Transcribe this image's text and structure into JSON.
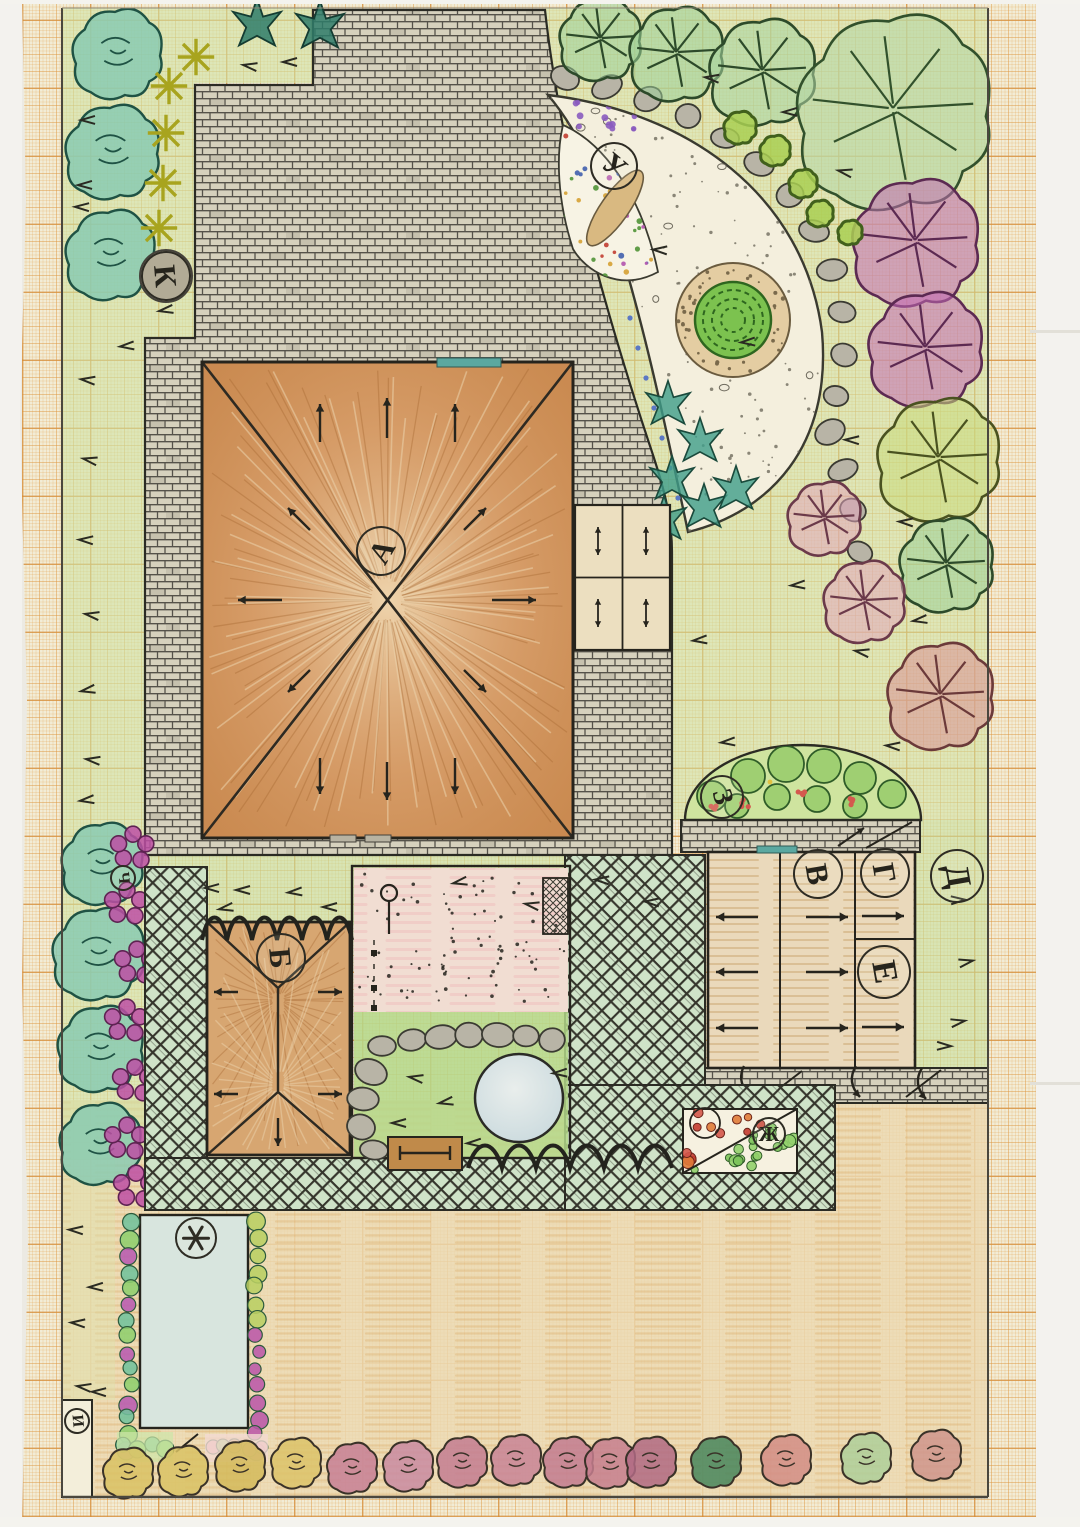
{
  "plan": {
    "description_labels_note": "hand-drawn garden plan, circled zone letters",
    "palette": {
      "paper": "#f2ecd6",
      "grid_orange": "#dd9a44",
      "lawn": "#c8e09b",
      "lawn_bright": "#b4d889",
      "brick": "#d6d1bd",
      "brick_joint": "#55524a",
      "roof_brown": "#d09a63",
      "roof_light": "#f2dcb6",
      "lattice_green": "#cfe3c8",
      "patio_pink": "#f1ddd2",
      "pond_blue": "#d9e4e2",
      "pool_water": "#d8e5de",
      "bare_ground_tan": "#ecd8b0",
      "teal_shrub": "#85c9b1",
      "magenta_flower": "#bd4fa5",
      "lime_bush": "#a9cf52",
      "window_teal": "#5ba8a0",
      "bench_wood": "#c08a4a",
      "box_orange": "#e0a33e"
    },
    "zone_labels": [
      {
        "letter": "А",
        "x": 381,
        "y": 551,
        "r": 25,
        "rot": -60
      },
      {
        "letter": "Б",
        "x": 281,
        "y": 958,
        "r": 25,
        "rot": 85
      },
      {
        "letter": "В",
        "x": 818,
        "y": 874,
        "r": 25,
        "rot": 80
      },
      {
        "letter": "Г",
        "x": 885,
        "y": 873,
        "r": 25,
        "rot": 80
      },
      {
        "letter": "Д",
        "x": 957,
        "y": 876,
        "r": 27,
        "rot": 80
      },
      {
        "letter": "Е",
        "x": 884,
        "y": 972,
        "r": 27,
        "rot": 80
      },
      {
        "letter": "Ж",
        "x": 769,
        "y": 1134,
        "r": 17,
        "rot": 0
      },
      {
        "letter": "З",
        "x": 722,
        "y": 797,
        "r": 22,
        "rot": 75
      },
      {
        "letter": "И",
        "x": 77,
        "y": 1421,
        "r": 13,
        "rot": 85
      },
      {
        "letter": "К",
        "x": 166,
        "y": 276,
        "r": 25,
        "rot": 85,
        "bg": "#b2ab96"
      },
      {
        "letter": "У",
        "x": 614,
        "y": 166,
        "r": 24,
        "rot": 40
      },
      {
        "letter": "Ч",
        "x": 123,
        "y": 878,
        "r": 13,
        "rot": 85
      },
      {
        "letter": "*",
        "x": 196,
        "y": 1238,
        "r": 21,
        "rot": 0,
        "star": true
      }
    ],
    "trees": [
      [
        600,
        38,
        40,
        "#9bcf97",
        "#2d4a2a"
      ],
      [
        676,
        52,
        46,
        "#9bcf97",
        "#2d4a2a"
      ],
      [
        762,
        70,
        52,
        "#a5d39e",
        "#2d4a2a"
      ],
      [
        893,
        108,
        95,
        "#b3d6a4",
        "#32512c"
      ],
      [
        915,
        240,
        62,
        "#c36ab4",
        "#5c2a52"
      ],
      [
        925,
        347,
        56,
        "#c36ab4",
        "#5c2a52"
      ],
      [
        938,
        457,
        60,
        "#c9da7c",
        "#4a5220"
      ],
      [
        946,
        563,
        46,
        "#9bcf97",
        "#2d4a2a"
      ],
      [
        864,
        600,
        40,
        "#e2a6bc",
        "#6b3a4a"
      ],
      [
        824,
        517,
        36,
        "#e2a6bc",
        "#6b3a4a"
      ],
      [
        940,
        694,
        52,
        "#d98f96",
        "#6b3a3a"
      ]
    ],
    "teal_shrubs": [
      [
        117,
        52,
        44
      ],
      [
        112,
        150,
        46
      ],
      [
        110,
        253,
        44
      ],
      [
        102,
        862,
        40
      ],
      [
        98,
        952,
        45
      ],
      [
        100,
        1047,
        42
      ],
      [
        100,
        1142,
        40
      ]
    ],
    "lime_bushes": [
      [
        740,
        127,
        16
      ],
      [
        775,
        150,
        15
      ],
      [
        803,
        183,
        14
      ],
      [
        820,
        213,
        13
      ],
      [
        850,
        232,
        12
      ]
    ],
    "magenta_clusters": [
      [
        133,
        847
      ],
      [
        127,
        903
      ],
      [
        137,
        962
      ],
      [
        127,
        1020
      ],
      [
        135,
        1080
      ],
      [
        127,
        1138
      ],
      [
        136,
        1186
      ]
    ],
    "yellow_flowers": [
      [
        196,
        57
      ],
      [
        169,
        86
      ],
      [
        166,
        133
      ],
      [
        163,
        183
      ],
      [
        159,
        228
      ]
    ],
    "dark_spiky_flowers": [
      [
        320,
        27
      ],
      [
        257,
        25
      ]
    ],
    "teal_plants": [
      [
        668,
        405
      ],
      [
        700,
        442
      ],
      [
        672,
        480
      ],
      [
        704,
        508
      ],
      [
        736,
        490
      ],
      [
        664,
        520
      ]
    ],
    "bed_bushes": [
      [
        712,
        796,
        15
      ],
      [
        748,
        776,
        17
      ],
      [
        786,
        764,
        18
      ],
      [
        824,
        766,
        17
      ],
      [
        860,
        778,
        16
      ],
      [
        892,
        794,
        14
      ],
      [
        737,
        806,
        12
      ],
      [
        777,
        797,
        13
      ],
      [
        817,
        799,
        13
      ],
      [
        855,
        806,
        12
      ]
    ],
    "bed_flower_dots": [
      [
        746,
        803
      ],
      [
        800,
        791
      ],
      [
        852,
        801
      ],
      [
        716,
        809
      ]
    ],
    "bottom_bushes": [
      [
        128,
        1472,
        "#d9c264"
      ],
      [
        183,
        1470,
        "#d9c264"
      ],
      [
        240,
        1465,
        "#d4ba5a"
      ],
      [
        296,
        1462,
        "#dcc36a"
      ],
      [
        352,
        1467,
        "#c77f95"
      ],
      [
        408,
        1465,
        "#c98ba2"
      ],
      [
        462,
        1461,
        "#c37d92"
      ],
      [
        516,
        1459,
        "#c88496"
      ],
      [
        568,
        1461,
        "#c27b90"
      ],
      [
        610,
        1462,
        "#c57e8e"
      ],
      [
        651,
        1461,
        "#b06a84"
      ],
      [
        716,
        1461,
        "#47855c"
      ],
      [
        786,
        1459,
        "#d28d86"
      ],
      [
        866,
        1457,
        "#aecf9a"
      ],
      [
        936,
        1454,
        "#cf958d"
      ]
    ],
    "stones_path": [
      [
        565,
        78
      ],
      [
        607,
        87
      ],
      [
        648,
        99
      ],
      [
        688,
        116
      ],
      [
        725,
        138
      ],
      [
        759,
        164
      ],
      [
        790,
        195
      ],
      [
        814,
        231
      ],
      [
        832,
        270
      ],
      [
        842,
        312
      ],
      [
        844,
        355
      ],
      [
        836,
        396
      ],
      [
        830,
        432
      ],
      [
        843,
        470
      ],
      [
        853,
        510
      ],
      [
        860,
        552
      ]
    ],
    "stones_lawn": [
      [
        382,
        1046
      ],
      [
        412,
        1040
      ],
      [
        441,
        1037
      ],
      [
        469,
        1035
      ],
      [
        498,
        1035
      ],
      [
        526,
        1036
      ],
      [
        552,
        1040
      ],
      [
        371,
        1072
      ],
      [
        363,
        1099
      ],
      [
        361,
        1127
      ],
      [
        374,
        1150
      ]
    ],
    "blue_dot_chain": [
      [
        630,
        318
      ],
      [
        638,
        348
      ],
      [
        646,
        378
      ],
      [
        654,
        408
      ],
      [
        662,
        438
      ],
      [
        670,
        468
      ],
      [
        678,
        498
      ]
    ],
    "grass_marks": [
      [
        250,
        66
      ],
      [
        290,
        62
      ],
      [
        88,
        120
      ],
      [
        85,
        185
      ],
      [
        82,
        207
      ],
      [
        166,
        310
      ],
      [
        127,
        346
      ],
      [
        88,
        380
      ],
      [
        90,
        460
      ],
      [
        86,
        540
      ],
      [
        92,
        615
      ],
      [
        88,
        690
      ],
      [
        93,
        760
      ],
      [
        87,
        800
      ],
      [
        712,
        78
      ],
      [
        790,
        112
      ],
      [
        845,
        172
      ],
      [
        748,
        342
      ],
      [
        906,
        522
      ],
      [
        798,
        585
      ],
      [
        862,
        652
      ],
      [
        728,
        742
      ],
      [
        893,
        746
      ],
      [
        700,
        640
      ],
      [
        920,
        620
      ],
      [
        852,
        440
      ],
      [
        660,
        250
      ],
      [
        212,
        888
      ],
      [
        243,
        890
      ],
      [
        295,
        892
      ],
      [
        226,
        908
      ],
      [
        330,
        907
      ],
      [
        460,
        882
      ],
      [
        532,
        905
      ],
      [
        602,
        880
      ],
      [
        652,
        902
      ],
      [
        416,
        1078
      ],
      [
        446,
        1102
      ],
      [
        399,
        1123
      ],
      [
        474,
        1143
      ],
      [
        560,
        1073
      ],
      [
        76,
        1230
      ],
      [
        96,
        1287
      ],
      [
        78,
        1323
      ],
      [
        84,
        1387
      ],
      [
        99,
        1392
      ],
      [
        958,
        900,
        1
      ],
      [
        966,
        962,
        1
      ],
      [
        958,
        1022,
        1
      ],
      [
        944,
        1046,
        1
      ]
    ],
    "pool_chain_colors": [
      "#72c19c",
      "#8fcf6e",
      "#b85bb0"
    ],
    "pool_right_top_color": "#b9cf63",
    "pool_right_bottom_color": "#bb58a8",
    "zh_bed_red_colors": [
      "#d4564a",
      "#e07b38",
      "#c43b30"
    ],
    "zh_bed_green_colors": [
      "#7cc35a",
      "#92d06c"
    ],
    "tri_bed_dot_colors": [
      "#c4463a",
      "#4a66b0",
      "#58983f",
      "#d7a43c",
      "#b55bb0"
    ]
  }
}
